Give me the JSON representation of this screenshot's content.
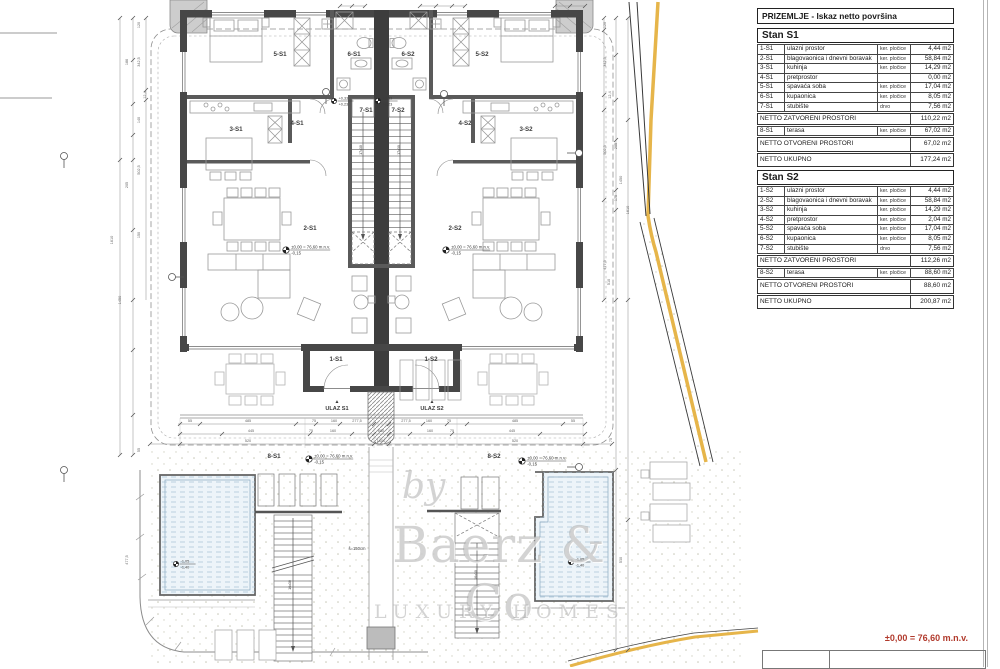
{
  "panel": {
    "title": "PRIZEMLJE - Iskaz netto površina",
    "stans": [
      {
        "name": "Stan S1",
        "rows": [
          {
            "id": "1-S1",
            "label": "ulazni prostor",
            "material": "ker. pločice",
            "area": "4,44 m2"
          },
          {
            "id": "2-S1",
            "label": "blagovaonica i dnevni boravak",
            "material": "ker. pločice",
            "area": "58,84 m2"
          },
          {
            "id": "3-S1",
            "label": "kuhinja",
            "material": "ker. pločice",
            "area": "14,29 m2"
          },
          {
            "id": "4-S1",
            "label": "pretprostor",
            "material": "",
            "area": "0,00 m2"
          },
          {
            "id": "5-S1",
            "label": "spavaća soba",
            "material": "ker. pločice",
            "area": "17,04 m2"
          },
          {
            "id": "6-S1",
            "label": "kupaonica",
            "material": "ker. pločice",
            "area": "8,05 m2"
          },
          {
            "id": "7-S1",
            "label": "stubište",
            "material": "drvo",
            "area": "7,56 m2"
          }
        ],
        "closed": {
          "label": "NETTO ZATVORENI PROSTORI",
          "area": "110,22 m2"
        },
        "terrace": {
          "id": "8-S1",
          "label": "terasa",
          "material": "ker. pločice",
          "area": "67,02 m2"
        },
        "open": {
          "label": "NETTO OTVORENI PROSTORI",
          "area": "67,02 m2"
        },
        "total": {
          "label": "NETTO UKUPNO",
          "area": "177,24 m2"
        }
      },
      {
        "name": "Stan S2",
        "rows": [
          {
            "id": "1-S2",
            "label": "ulazni prostor",
            "material": "ker. pločice",
            "area": "4,44 m2"
          },
          {
            "id": "2-S2",
            "label": "blagovaonica i dnevni boravak",
            "material": "ker. pločice",
            "area": "58,84 m2"
          },
          {
            "id": "3-S2",
            "label": "kuhinja",
            "material": "ker. pločice",
            "area": "14,29 m2"
          },
          {
            "id": "4-S2",
            "label": "pretprostor",
            "material": "ker. pločice",
            "area": "2,04 m2"
          },
          {
            "id": "5-S2",
            "label": "spavaća soba",
            "material": "ker. pločice",
            "area": "17,04 m2"
          },
          {
            "id": "6-S2",
            "label": "kupaonica",
            "material": "ker. pločice",
            "area": "8,05 m2"
          },
          {
            "id": "7-S2",
            "label": "stubište",
            "material": "drvo",
            "area": "7,56 m2"
          }
        ],
        "closed": {
          "label": "NETTO ZATVORENI PROSTORI",
          "area": "112,26 m2"
        },
        "terrace": {
          "id": "8-S2",
          "label": "terasa",
          "material": "ker. pločice",
          "area": "88,60 m2"
        },
        "open": {
          "label": "NETTO OTVORENI PROSTORI",
          "area": "88,60 m2"
        },
        "total": {
          "label": "NETTO UKUPNO",
          "area": "200,87 m2"
        }
      }
    ]
  },
  "watermark": {
    "by": "by",
    "brand": "Baerz & Co",
    "tagline": "LUXURY HOMES"
  },
  "footer": {
    "elevation_note": "±0,00 = 76,60 m.n.v."
  },
  "plan": {
    "room_labels": [
      {
        "t": "5-S1",
        "x": 280,
        "y": 56
      },
      {
        "t": "6-S1",
        "x": 354,
        "y": 56
      },
      {
        "t": "6-S2",
        "x": 408,
        "y": 56
      },
      {
        "t": "5-S2",
        "x": 482,
        "y": 56
      },
      {
        "t": "3-S1",
        "x": 236,
        "y": 131
      },
      {
        "t": "4-S1",
        "x": 297,
        "y": 125
      },
      {
        "t": "7-S1",
        "x": 366,
        "y": 112
      },
      {
        "t": "7-S2",
        "x": 398,
        "y": 112
      },
      {
        "t": "4-S2",
        "x": 465,
        "y": 125
      },
      {
        "t": "3-S2",
        "x": 526,
        "y": 131
      },
      {
        "t": "2-S1",
        "x": 310,
        "y": 230
      },
      {
        "t": "2-S2",
        "x": 455,
        "y": 230
      },
      {
        "t": "1-S1",
        "x": 336,
        "y": 361
      },
      {
        "t": "1-S2",
        "x": 431,
        "y": 361
      },
      {
        "t": "8-S1",
        "x": 274,
        "y": 458
      },
      {
        "t": "8-S2",
        "x": 494,
        "y": 458
      }
    ],
    "entry_labels": [
      {
        "t": "▲",
        "x": 337,
        "y": 403,
        "s": 5
      },
      {
        "t": "▲",
        "x": 432,
        "y": 403,
        "s": 5
      },
      {
        "t": "ULAZ S1",
        "x": 337,
        "y": 410,
        "s": 5.6,
        "w": "bold"
      },
      {
        "t": "ULAZ S2",
        "x": 432,
        "y": 410,
        "s": 5.6,
        "w": "bold"
      },
      {
        "t": "š=150cm",
        "x": 357,
        "y": 550,
        "s": 4.2
      },
      {
        "t": "17x30",
        "x": 362,
        "y": 150,
        "s": 3.6,
        "r": -90
      },
      {
        "t": "17x30",
        "x": 400,
        "y": 150,
        "s": 3.6,
        "r": -90
      },
      {
        "t": "16x30",
        "x": 291,
        "y": 585,
        "s": 3.6,
        "r": -90
      },
      {
        "t": "16x30",
        "x": 477,
        "y": 575,
        "s": 3.6,
        "r": -90
      }
    ],
    "elevation_markers": [
      {
        "x": 286,
        "y": 250,
        "a": "±0,00 = 76,60 m.n.v.",
        "b": "-0,15"
      },
      {
        "x": 446,
        "y": 250,
        "a": "±0,00 = 76,60 m.n.v.",
        "b": "-0,15"
      },
      {
        "x": 309,
        "y": 459,
        "a": "±0,00 = 76,60 m.n.v.",
        "b": "-0,15"
      },
      {
        "x": 522,
        "y": 461,
        "a": "±0,00 = 76,60 m.n.v.",
        "b": "-0,15"
      },
      {
        "x": 176,
        "y": 564,
        "a": "-1,05",
        "b": "-1,40",
        "small": true
      },
      {
        "x": 571,
        "y": 562,
        "a": "-1,05",
        "b": "-1,40",
        "small": true
      },
      {
        "x": 334,
        "y": 101,
        "a": "+0,33",
        "b": "+0,23",
        "small": true
      },
      {
        "x": 378,
        "y": 101,
        "a": "+0,33",
        "b": "+0,23",
        "small": true
      }
    ],
    "dims_bottom": [
      {
        "t": "55",
        "x": 190,
        "y": 422
      },
      {
        "t": "485",
        "x": 248,
        "y": 422
      },
      {
        "t": "75",
        "x": 314,
        "y": 422
      },
      {
        "t": "160",
        "x": 334,
        "y": 422
      },
      {
        "t": "277,5",
        "x": 357,
        "y": 422
      },
      {
        "t": "277,5",
        "x": 406,
        "y": 422
      },
      {
        "t": "160",
        "x": 429,
        "y": 422
      },
      {
        "t": "75",
        "x": 449,
        "y": 422
      },
      {
        "t": "485",
        "x": 515,
        "y": 422
      },
      {
        "t": "55",
        "x": 573,
        "y": 422
      },
      {
        "t": "445",
        "x": 251,
        "y": 432
      },
      {
        "t": "75",
        "x": 311,
        "y": 432
      },
      {
        "t": "160",
        "x": 333,
        "y": 432
      },
      {
        "t": "680",
        "x": 381,
        "y": 432
      },
      {
        "t": "160",
        "x": 430,
        "y": 432
      },
      {
        "t": "75",
        "x": 452,
        "y": 432
      },
      {
        "t": "445",
        "x": 512,
        "y": 432
      },
      {
        "t": "520",
        "x": 248,
        "y": 442
      },
      {
        "t": "1600",
        "x": 381,
        "y": 442
      },
      {
        "t": "520",
        "x": 515,
        "y": 442
      }
    ],
    "dims_left": [
      {
        "t": "120",
        "x": 140,
        "y": 25
      },
      {
        "t": "342,5",
        "x": 140,
        "y": 62
      },
      {
        "t": "186",
        "x": 128,
        "y": 62
      },
      {
        "t": "12,4",
        "x": 146,
        "y": 95
      },
      {
        "t": "140",
        "x": 140,
        "y": 120
      },
      {
        "t": "502,5",
        "x": 140,
        "y": 170
      },
      {
        "t": "205",
        "x": 128,
        "y": 185
      },
      {
        "t": "1610",
        "x": 113,
        "y": 240
      },
      {
        "t": "150",
        "x": 140,
        "y": 235
      },
      {
        "t": "1450",
        "x": 121,
        "y": 300
      },
      {
        "t": "55",
        "x": 140,
        "y": 450
      },
      {
        "t": "477,5",
        "x": 128,
        "y": 560
      }
    ],
    "dims_right": [
      {
        "t": "120",
        "x": 606,
        "y": 25
      },
      {
        "t": "342,5",
        "x": 606,
        "y": 62
      },
      {
        "t": "12,4",
        "x": 611,
        "y": 95
      },
      {
        "t": "502,5",
        "x": 606,
        "y": 150
      },
      {
        "t": "205",
        "x": 617,
        "y": 146
      },
      {
        "t": "1450",
        "x": 622,
        "y": 180
      },
      {
        "t": "175",
        "x": 617,
        "y": 198
      },
      {
        "t": "1610",
        "x": 629,
        "y": 210
      },
      {
        "t": "477,5",
        "x": 606,
        "y": 265
      },
      {
        "t": "510",
        "x": 610,
        "y": 282
      },
      {
        "t": "75",
        "x": 612,
        "y": 440
      },
      {
        "t": "510",
        "x": 622,
        "y": 560
      }
    ]
  },
  "colors": {
    "boundary_yellow": "#E6B54A",
    "note_red": "#B13A2C",
    "pool_fill": "#EDF4F9",
    "wall": "#474747"
  }
}
